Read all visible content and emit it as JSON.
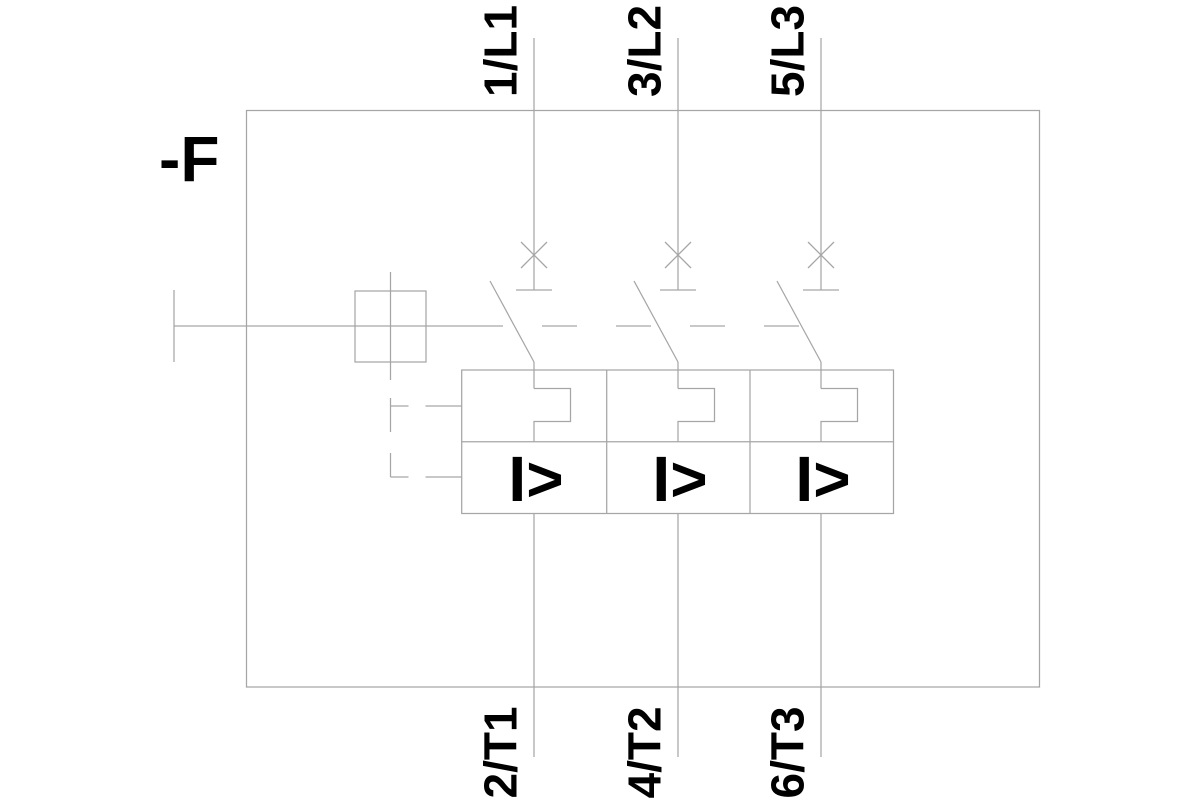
{
  "schematic": {
    "device_label": "-F",
    "poles": [
      {
        "top_terminal": "1/L1",
        "bottom_terminal": "2/T1",
        "overcurrent_release_label": "I>"
      },
      {
        "top_terminal": "3/L2",
        "bottom_terminal": "4/T2",
        "overcurrent_release_label": "I>"
      },
      {
        "top_terminal": "5/L3",
        "bottom_terminal": "6/T3",
        "overcurrent_release_label": "I>"
      }
    ],
    "colors": {
      "line": "#a6a6a6",
      "label_text": "#000000",
      "background": "#ffffff"
    }
  }
}
